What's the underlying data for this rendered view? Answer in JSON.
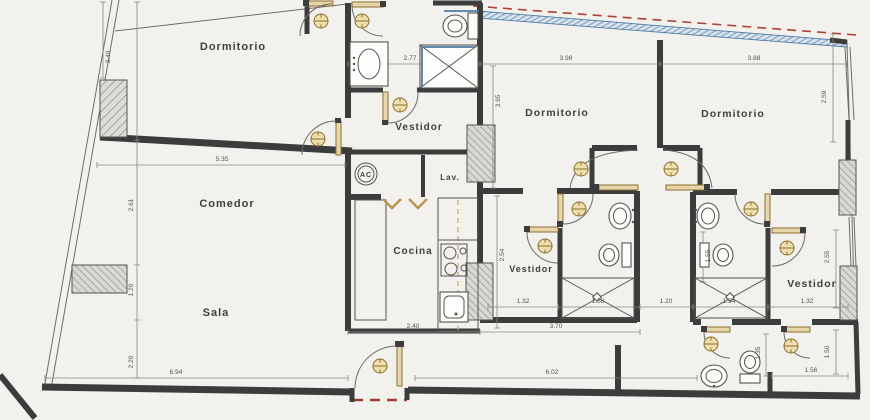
{
  "document": {
    "kind_label": "floor-plan-scan"
  },
  "rooms": [
    {
      "id": "dormitorio-1",
      "label": "Dormitorio",
      "x": 233,
      "y": 50,
      "fs": 11
    },
    {
      "id": "vestidor-1",
      "label": "Vestidor",
      "x": 419,
      "y": 130,
      "fs": 10
    },
    {
      "id": "dormitorio-2",
      "label": "Dormitorio",
      "x": 557,
      "y": 116,
      "fs": 10.5
    },
    {
      "id": "dormitorio-3",
      "label": "Dormitorio",
      "x": 733,
      "y": 117,
      "fs": 10.5
    },
    {
      "id": "comedor",
      "label": "Comedor",
      "x": 227,
      "y": 207,
      "fs": 11
    },
    {
      "id": "cocina",
      "label": "Cocina",
      "x": 413,
      "y": 254,
      "fs": 10
    },
    {
      "id": "vestidor-2",
      "label": "Vestidor",
      "x": 531,
      "y": 272,
      "fs": 9
    },
    {
      "id": "sala",
      "label": "Sala",
      "x": 216,
      "y": 316,
      "fs": 11
    },
    {
      "id": "vestidor-3",
      "label": "Vestidor",
      "x": 812,
      "y": 287,
      "fs": 10.5
    },
    {
      "id": "lavanderia",
      "label": "Lav.",
      "x": 450,
      "y": 180,
      "fs": 8
    }
  ],
  "symbols": {
    "ac_label": "AC"
  },
  "dimensions": [
    {
      "v": "3.40",
      "x": 110,
      "y": 57,
      "rot": true
    },
    {
      "v": "5.35",
      "x": 222,
      "y": 161,
      "rot": false
    },
    {
      "v": "2.61",
      "x": 133,
      "y": 205,
      "rot": true
    },
    {
      "v": "1.20",
      "x": 133,
      "y": 290,
      "rot": true
    },
    {
      "v": "2.20",
      "x": 133,
      "y": 362,
      "rot": true
    },
    {
      "v": "6.94",
      "x": 176,
      "y": 374,
      "rot": false
    },
    {
      "v": "2.77",
      "x": 410,
      "y": 60,
      "rot": false
    },
    {
      "v": "3.98",
      "x": 566,
      "y": 60,
      "rot": false
    },
    {
      "v": "3.88",
      "x": 754,
      "y": 60,
      "rot": false
    },
    {
      "v": "3.95",
      "x": 500,
      "y": 101,
      "rot": true
    },
    {
      "v": "2.59",
      "x": 826,
      "y": 97,
      "rot": true
    },
    {
      "v": "2.54",
      "x": 504,
      "y": 255,
      "rot": true
    },
    {
      "v": "2.40",
      "x": 413,
      "y": 328,
      "rot": false
    },
    {
      "v": "3.70",
      "x": 556,
      "y": 328,
      "rot": false
    },
    {
      "v": "1.32",
      "x": 523,
      "y": 303,
      "rot": false
    },
    {
      "v": "1.58",
      "x": 598,
      "y": 303,
      "rot": false
    },
    {
      "v": "1.20",
      "x": 666,
      "y": 303,
      "rot": false
    },
    {
      "v": "1.54",
      "x": 729,
      "y": 303,
      "rot": false
    },
    {
      "v": "1.32",
      "x": 807,
      "y": 303,
      "rot": false
    },
    {
      "v": "2.55",
      "x": 829,
      "y": 257,
      "rot": true
    },
    {
      "v": "1.55",
      "x": 710,
      "y": 256,
      "rot": true
    },
    {
      "v": "6.02",
      "x": 552,
      "y": 374,
      "rot": false
    },
    {
      "v": "1.35",
      "x": 760,
      "y": 353,
      "rot": true
    },
    {
      "v": "1.50",
      "x": 829,
      "y": 352,
      "rot": true
    },
    {
      "v": "1.56",
      "x": 811,
      "y": 372,
      "rot": false
    }
  ],
  "colors": {
    "wall": "#3c3c3c",
    "door_leaf": "#e7d6ab",
    "knob": "#eedfae",
    "glass": "#4d7ca6",
    "red_dashed": "#b04038",
    "paper": "#f3f1ed",
    "pillar_hatch": "#908e88"
  }
}
